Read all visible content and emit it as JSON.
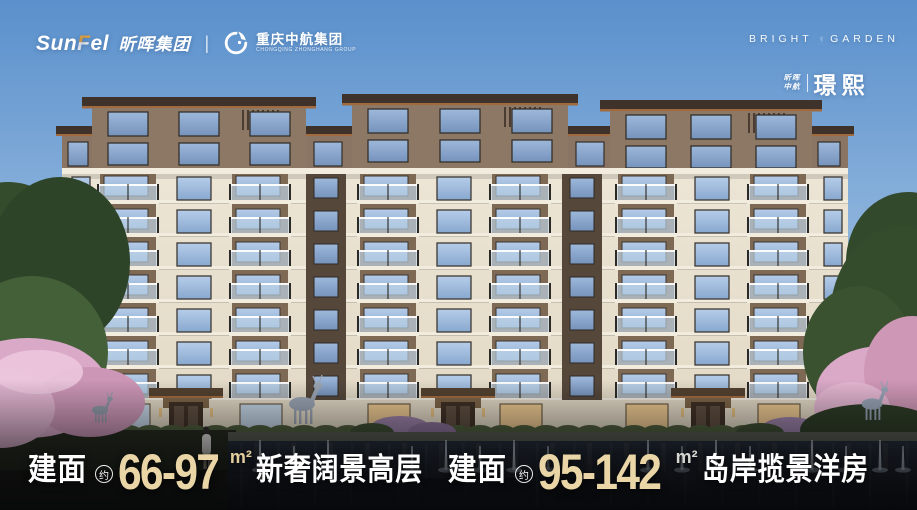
{
  "brand_bar": {
    "sunfel": {
      "latin_part1": "Sun",
      "latin_accent": "F",
      "latin_part2": "el",
      "cn": "昕晖集团"
    },
    "divider": "|",
    "zhonghang": {
      "cn": "重庆中航集团",
      "en": "CHONGQING ZHONGHANG GROUP"
    },
    "project": {
      "en_left": "BRIGHT",
      "en_right": "GARDEN",
      "owner_line1": "昕晖",
      "owner_line2": "中航",
      "name": "璟熙"
    }
  },
  "tagline": {
    "segments": [
      {
        "label": "建面",
        "approx": "约",
        "range": "66-97",
        "unit": "m²",
        "desc": "新奢阔景高层",
        "range_color": "#e9d5a6",
        "unit_color": "#e2cd9d"
      },
      {
        "label": "建面",
        "approx": "约",
        "range": "95-142",
        "unit": "m²",
        "desc": "岛岸揽景洋房",
        "range_color": "#e9d5a6",
        "unit_color": "#d5d8d2"
      }
    ]
  },
  "colors": {
    "sky_top": "#5a90cc",
    "sky_horizon": "#b8d1ea",
    "roof_dark": "#3e322a",
    "copper": "#a06a3e",
    "brown_wall": "#8d7866",
    "brown_band": "#8a7565",
    "brown_recess": "#7e6955",
    "cream_wall": "#ece5d5",
    "cream_low": "#e2d8c4",
    "slab_white": "#f2ecdf",
    "glass_top": "#b6cde9",
    "glass_bot": "#88a8cf",
    "balustrade": "#c3d7ea",
    "warm_window": "#ecc88f",
    "pool_dark": "#161c26",
    "stone_edge": "#565a50",
    "hedge": "#47573a",
    "tree_green": "#344b2c",
    "blossom": "#d9a9c7",
    "gold": "#e9d5a6",
    "white": "#ffffff"
  }
}
